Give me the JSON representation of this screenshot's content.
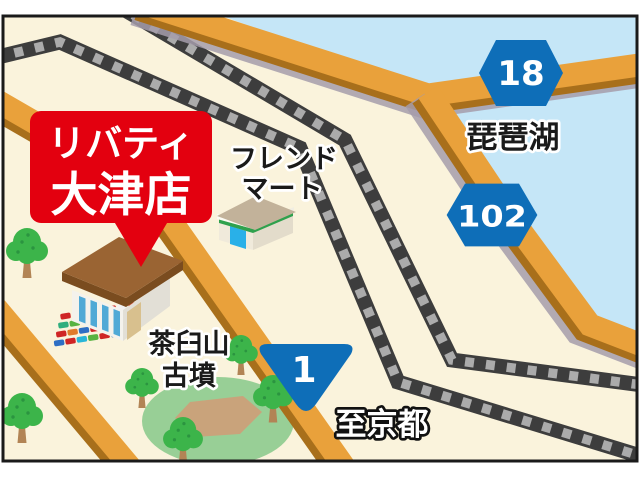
{
  "store_callout": {
    "line1": "リバティ",
    "line2": "大津店"
  },
  "labels": {
    "lake": "琵琶湖",
    "friend_mart_1": "フレンド",
    "friend_mart_2": "マート",
    "kofun_1": "茶臼山",
    "kofun_2": "古墳",
    "to_kyoto": "至京都"
  },
  "route_badges": {
    "prefectural_18": "18",
    "prefectural_102": "102",
    "national_1": "1"
  },
  "colors": {
    "land": "#FAF3DC",
    "lake": "#C5E6F7",
    "road": "#E9A13B",
    "road_edge": "#A86F1B",
    "road_shadow": "#A49CAA",
    "railway": "#3D3D3D",
    "railway_tie": "#ABABAB",
    "badge_blue": "#0E6EB8",
    "callout_red": "#E3000F",
    "tree_green": "#3CB44A",
    "tree_trunk": "#B28455",
    "kofun_green": "#98CF96",
    "kofun_path": "#C9A37B"
  },
  "trees": [
    {
      "x": 27,
      "y": 248,
      "s": 1.0
    },
    {
      "x": 22,
      "y": 413,
      "s": 1.0
    },
    {
      "x": 142,
      "y": 384,
      "s": 0.8
    },
    {
      "x": 183,
      "y": 436,
      "s": 0.95
    },
    {
      "x": 241,
      "y": 351,
      "s": 0.8
    },
    {
      "x": 273,
      "y": 394,
      "s": 0.95
    }
  ],
  "car_lot": {
    "rows": 4,
    "cols": 7,
    "palette": [
      "#cf2525",
      "#f2f2f2",
      "#cf2525",
      "#2e6fc4",
      "#cf2525",
      "#f2f2f2",
      "#d8452a",
      "#2fae7e",
      "#57b341",
      "#f2f2f2",
      "#2e6fc4",
      "#2fae7e",
      "#cf2525",
      "#57b341",
      "#cf2525",
      "#e07b2a",
      "#2e6fc4",
      "#cf2525",
      "#29b6d8",
      "#cf2525",
      "#f2f2f2",
      "#2e6fc4",
      "#cf2525",
      "#29b6d8",
      "#57b341",
      "#cf2525",
      "#2e6fc4",
      "#444444"
    ]
  }
}
